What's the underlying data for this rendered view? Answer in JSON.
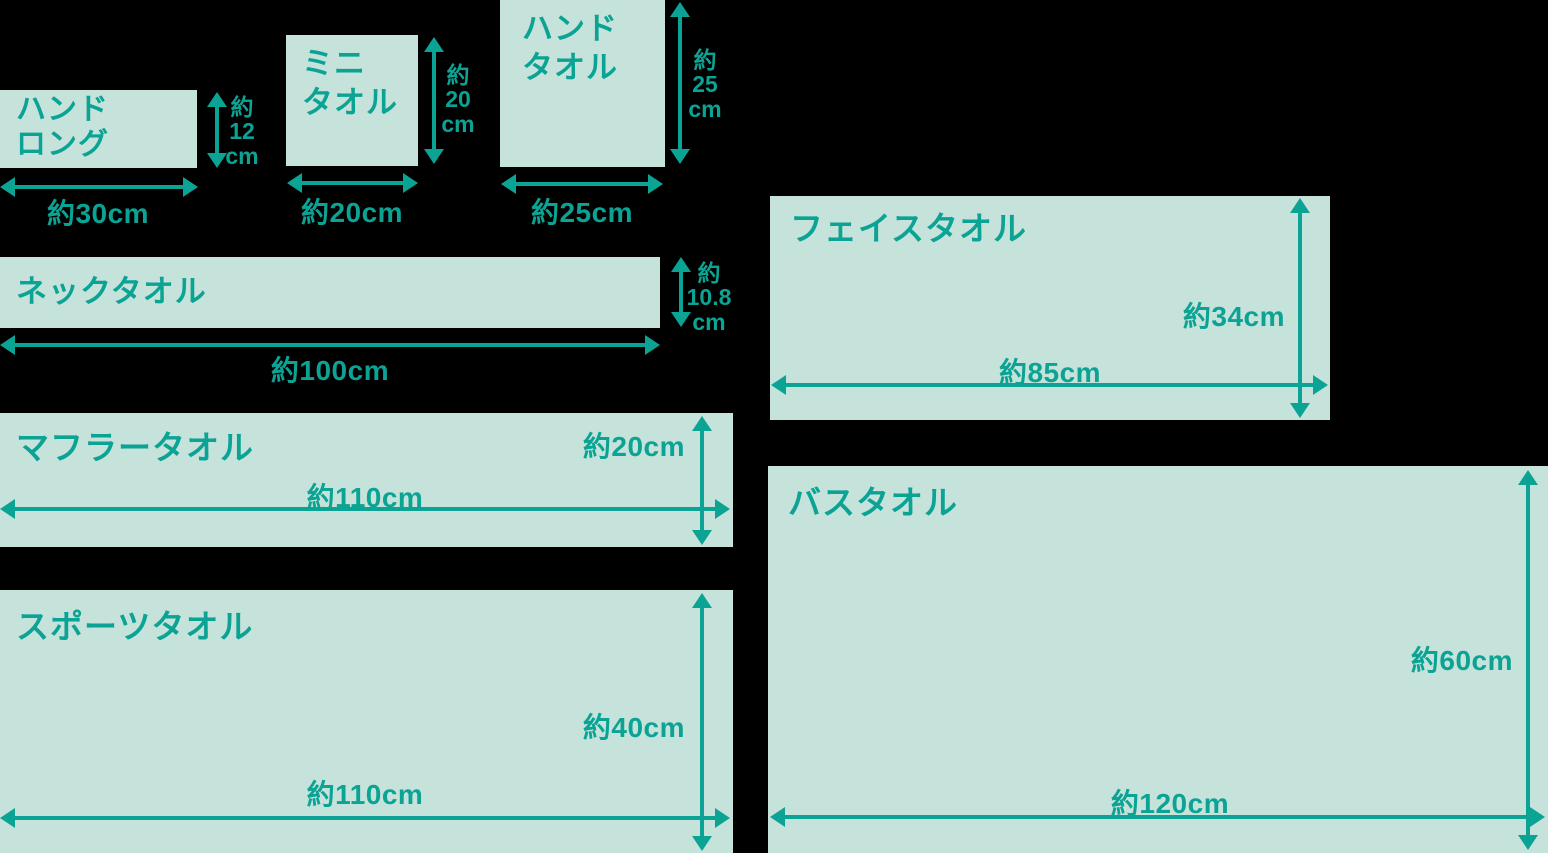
{
  "diagram": {
    "description_colors": {
      "background": "#000000",
      "towel_fill": "#c5e2db",
      "accent_teal": "#0ba394"
    }
  },
  "towels": [
    {
      "id": "hand-long",
      "name": "ハンド\nロング",
      "width_label": "約30cm",
      "height_label": "約\n12\ncm",
      "width_cm": 30,
      "height_cm": 12
    },
    {
      "id": "mini-towel",
      "name": "ミニ\nタオル",
      "width_label": "約20cm",
      "height_label": "約\n20\ncm",
      "width_cm": 20,
      "height_cm": 20
    },
    {
      "id": "hand-towel",
      "name": "ハンド\nタオル",
      "width_label": "約25cm",
      "height_label": "約\n25\ncm",
      "width_cm": 25,
      "height_cm": 25
    },
    {
      "id": "neck-towel",
      "name": "ネックタオル",
      "width_label": "約100cm",
      "height_label": "約\n10.8\ncm",
      "width_cm": 100,
      "height_cm": 10.8
    },
    {
      "id": "face-towel",
      "name": "フェイスタオル",
      "width_label": "約85cm",
      "height_label": "約34cm",
      "width_cm": 85,
      "height_cm": 34
    },
    {
      "id": "muffler-towel",
      "name": "マフラータオル",
      "width_label": "約110cm",
      "height_label": "約20cm",
      "width_cm": 110,
      "height_cm": 20
    },
    {
      "id": "bath-towel",
      "name": "バスタオル",
      "width_label": "約120cm",
      "height_label": "約60cm",
      "width_cm": 120,
      "height_cm": 60
    },
    {
      "id": "sports-towel",
      "name": "スポーツタオル",
      "width_label": "約110cm",
      "height_label": "約40cm",
      "width_cm": 110,
      "height_cm": 40
    }
  ]
}
